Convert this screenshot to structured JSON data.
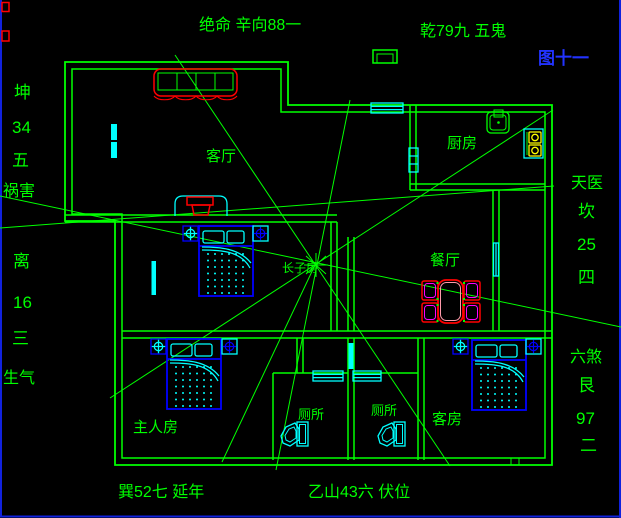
{
  "figure": {
    "type": "feng-shui annotated floor plan (CAD style)",
    "figure_label": "图十一"
  },
  "annotations": {
    "top_left": "绝命 辛向88一",
    "top_right": "乾79九 五鬼",
    "figure_label": "图十一",
    "left_top": [
      "坤",
      "34",
      "五",
      "祸害"
    ],
    "left_bottom": [
      "离",
      "16",
      "三",
      "生气"
    ],
    "right_top": [
      "天医",
      "坎",
      "25",
      "四"
    ],
    "right_bottom": [
      "六煞",
      "艮",
      "97",
      "二"
    ],
    "bottom_left": "巽52七 延年",
    "bottom_center": "乙山43六 伏位"
  },
  "rooms": {
    "living_room": "客厅",
    "kitchen": "厨房",
    "dining_room": "餐厅",
    "eldest_son_room": "长子房",
    "master_bedroom": "主人房",
    "toilet_left": "厕所",
    "toilet_right": "厕所",
    "guest_room": "客房"
  },
  "colors": {
    "background": "#000000",
    "wall_green": "#00FF00",
    "furniture_red": "#FF0000",
    "fixture_cyan": "#00FFFF",
    "bed_blue": "#0000FF",
    "figure_label_blue": "#2233FF",
    "chair_magenta": "#FF00FF",
    "burner_yellow": "#FFFF00",
    "border_blue": "#1122DD"
  }
}
